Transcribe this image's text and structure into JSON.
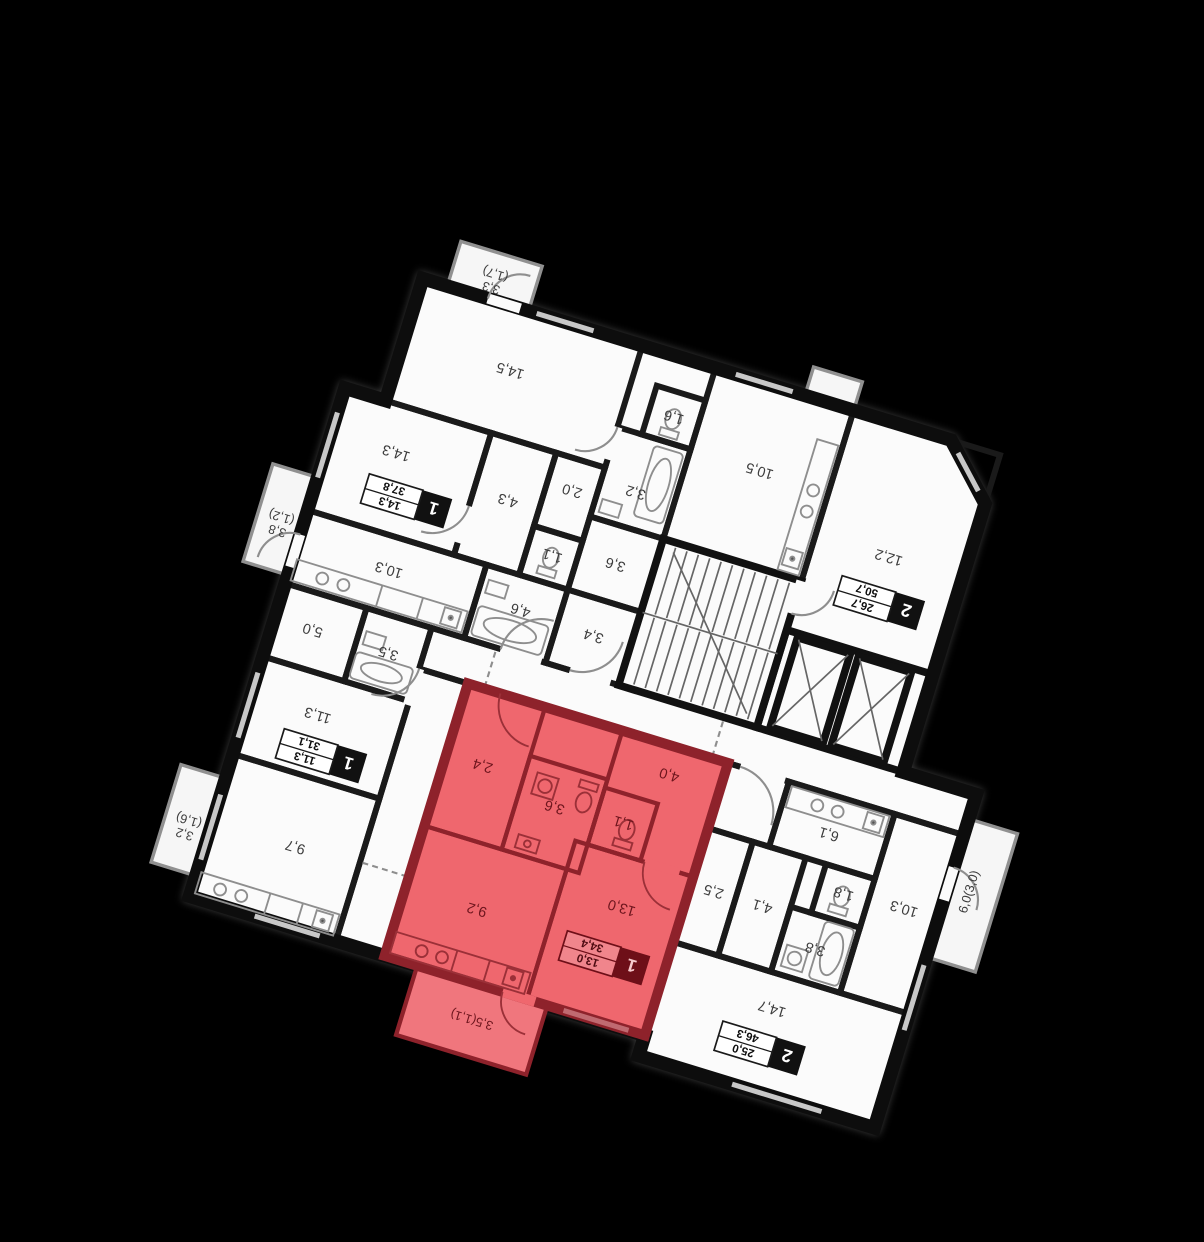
{
  "plan": {
    "background_color": "#000000",
    "floor_color": "#fbfbfb",
    "wall_color": "#0d0d0d",
    "highlight_fill": "#ef676e",
    "highlight_wall": "#8e222b",
    "highlight_text": "#6d151d",
    "label_color": "#3c3c3c",
    "apartments": [
      {
        "id": "50-7",
        "type": "2",
        "living": "26,7",
        "total": "50,7",
        "highlighted": false,
        "badge": {
          "x": 205,
          "y": 622
        },
        "rooms": [
          {
            "label": "12,2",
            "x": 210,
            "y": 682
          },
          {
            "label": "10,5",
            "x": 385,
            "y": 735
          },
          {
            "label": "3,4",
            "x": 515,
            "y": 492
          },
          {
            "label": "3,6",
            "x": 515,
            "y": 580
          },
          {
            "label": "3,2",
            "x": 517,
            "y": 668
          },
          {
            "label": "1,6",
            "x": 500,
            "y": 766
          },
          {
            "label": "14,5",
            "x": 700,
            "y": 762
          }
        ],
        "balconies": [
          {
            "label": "3,3",
            "label2": "(1,7)",
            "x": 750,
            "y": 852
          }
        ]
      },
      {
        "id": "37-8",
        "type": "1",
        "living": "14,3",
        "total": "37,8",
        "highlighted": false,
        "badge": {
          "x": 772,
          "y": 574
        },
        "rooms": [
          {
            "label": "14,3",
            "x": 800,
            "y": 630
          },
          {
            "label": "4,3",
            "x": 658,
            "y": 615
          },
          {
            "label": "10,3",
            "x": 768,
            "y": 496
          },
          {
            "label": "4,6",
            "x": 606,
            "y": 496
          },
          {
            "label": "1,1",
            "x": 589,
            "y": 568
          },
          {
            "label": "2,0",
            "x": 589,
            "y": 648
          }
        ],
        "balconies": [
          {
            "label": "3,8",
            "label2": "(1,2)",
            "x": 907,
            "y": 505
          }
        ]
      },
      {
        "id": "34-4",
        "type": "1",
        "living": "13,0",
        "total": "34,4",
        "highlighted": true,
        "badge": {
          "x": 392,
          "y": 128
        },
        "rooms": [
          {
            "label": "13,0",
            "x": 390,
            "y": 196
          },
          {
            "label": "9,2",
            "x": 552,
            "y": 144
          },
          {
            "label": "1,1",
            "x": 417,
            "y": 292
          },
          {
            "label": "3,6",
            "x": 500,
            "y": 286
          },
          {
            "label": "4,0",
            "x": 382,
            "y": 362
          },
          {
            "label": "2,4",
            "x": 595,
            "y": 308
          }
        ],
        "balconies": [
          {
            "label": "3,5(1,1)",
            "x": 520,
            "y": 18
          }
        ]
      },
      {
        "id": "31-1",
        "type": "1",
        "living": "11,3",
        "total": "31,1",
        "highlighted": false,
        "badge": {
          "x": 780,
          "y": 258
        },
        "rooms": [
          {
            "label": "11,3",
            "x": 798,
            "y": 308
          },
          {
            "label": "9,7",
            "x": 778,
            "y": 152
          },
          {
            "label": "3,5",
            "x": 740,
            "y": 402
          },
          {
            "label": "5,0",
            "x": 833,
            "y": 402
          }
        ],
        "balconies": [
          {
            "label": "3,2",
            "label2": "(1,6)",
            "x": 907,
            "y": 132
          }
        ]
      },
      {
        "id": "46-3",
        "type": "2",
        "living": "25,0",
        "total": "46,3",
        "highlighted": false,
        "badge": {
          "x": 186,
          "y": 80
        },
        "rooms": [
          {
            "label": "14,7",
            "x": 186,
            "y": 134
          },
          {
            "label": "10,3",
            "x": 72,
            "y": 292
          },
          {
            "label": "6,1",
            "x": 182,
            "y": 350
          },
          {
            "label": "3,8",
            "x": 158,
            "y": 216
          },
          {
            "label": "1,8",
            "x": 145,
            "y": 288
          },
          {
            "label": "4,1",
            "x": 232,
            "y": 246
          },
          {
            "label": "2,5",
            "x": 292,
            "y": 246
          }
        ],
        "balconies": [
          {
            "label": "6,0(3,0)",
            "x": 0,
            "y": 328,
            "rot": 90
          }
        ]
      }
    ]
  }
}
